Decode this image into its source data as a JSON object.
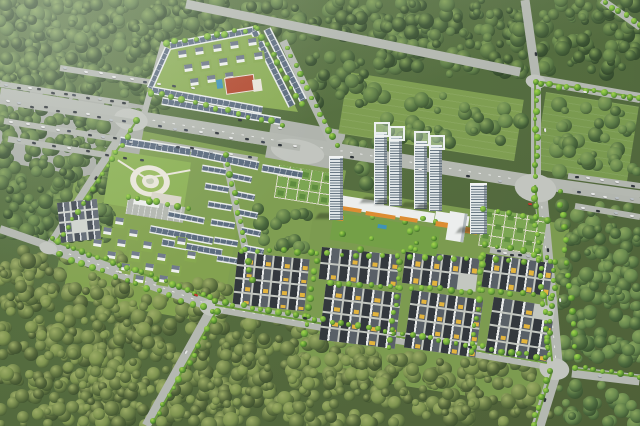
{
  "scene": {
    "description": "Aerial perspective rendering of a master-planned residential development: gated villa compound, high-rise twin towers with retail podium, rows of dark-roofed townhouses with yellow balconies, central amphitheater park, formal parterre gardens and tree-lined boulevards, all surrounded by dense forest",
    "size": {
      "w": 640,
      "h": 426
    },
    "seed": 20240712,
    "palette": {
      "road": "#b4b8b1",
      "road_light": "#c2c5bf",
      "asphalt": "#a9ada6",
      "hedge": "#6f9c3f",
      "forest_dark": [
        "#3d5634",
        "#49653c",
        "#567343",
        "#5f7e49"
      ],
      "forest_dark_hi": "#82a058",
      "forest_mid": [
        "#4c6a3e",
        "#5a7a46",
        "#68894e"
      ],
      "forest_mid_hi": "#8aa65e",
      "forest_olive": [
        "#54663a",
        "#617541",
        "#6f8449",
        "#7d934f"
      ],
      "forest_olive_hi": "#9cac66",
      "street_tree": [
        "#5d9a33",
        "#6fae3b"
      ],
      "street_tree_hi": "#a8d44f",
      "grass": "#7f9e52",
      "lawn": "#8db257",
      "roof_slate": "#5b6b7e",
      "wall_white": "#e9ecec",
      "unit_dark_l": "#33383d",
      "unit_dark_r": "#596067",
      "unit_ridge": "#e9ebea",
      "unit_ground": "#c3c7c0",
      "accent_yellow": "#e3b43d",
      "slate_l": "#454c55",
      "slate_r": "#626a74",
      "slate_ground": "#cfd3cd",
      "tower_face": "#dfe5e7",
      "tower_band": "#6b7a86",
      "tower_cap": "#f2f4f4",
      "podium_white": "#eceeed",
      "podium_orange": "#dd8d33",
      "court_red": "#b2492f",
      "pool_blue": "#3f93b8",
      "park_path": "#e9e6da",
      "plaza": "#d9d5c8",
      "garden_base": "#7ca653",
      "garden_hedge": "#5e8c3f",
      "garden_line": "#dedaca"
    },
    "car_colors": [
      "#2c3237",
      "#e6e7e6",
      "#b9bfc4",
      "#30363c",
      "#3c4450",
      "#e6e7e6"
    ],
    "grass_pads": [
      [
        86,
        120,
        265,
        160,
        11,
        "#7f9e52"
      ],
      [
        80,
        198,
        160,
        100,
        10,
        "#83a250"
      ],
      [
        318,
        185,
        255,
        185,
        9,
        "#7c9b50"
      ],
      [
        0,
        80,
        150,
        80,
        10,
        "#a9ada6"
      ],
      [
        272,
        118,
        75,
        40,
        10,
        "#b0b4ad"
      ]
    ],
    "meadows": [
      [
        348,
        72,
        178,
        62,
        9,
        "#7f9e52"
      ],
      [
        546,
        92,
        94,
        78,
        9,
        "#7a9a50"
      ]
    ],
    "forest_zones": [
      [
        0,
        0,
        200,
        92,
        85,
        "dark"
      ],
      [
        0,
        58,
        110,
        180,
        85,
        "dark"
      ],
      [
        58,
        138,
        52,
        80,
        110,
        "dark"
      ],
      [
        148,
        0,
        235,
        40,
        85,
        "dark"
      ],
      [
        378,
        0,
        150,
        74,
        85,
        "dark"
      ],
      [
        538,
        0,
        102,
        74,
        85,
        "dark"
      ],
      [
        120,
        25,
        48,
        100,
        110,
        "dark"
      ],
      [
        305,
        55,
        80,
        50,
        110,
        "dark"
      ],
      [
        555,
        100,
        85,
        72,
        160,
        "mid"
      ],
      [
        560,
        205,
        80,
        160,
        95,
        "mid"
      ],
      [
        558,
        385,
        82,
        41,
        110,
        "mid"
      ],
      [
        338,
        142,
        46,
        52,
        160,
        "mid"
      ],
      [
        246,
        202,
        66,
        46,
        160,
        "mid"
      ],
      [
        378,
        96,
        150,
        48,
        220,
        "mid"
      ],
      [
        0,
        250,
        125,
        176,
        85,
        "olive"
      ],
      [
        95,
        282,
        135,
        144,
        85,
        "olive"
      ],
      [
        205,
        322,
        175,
        104,
        85,
        "olive"
      ],
      [
        355,
        358,
        195,
        68,
        95,
        "olive"
      ]
    ],
    "roads": [
      [
        0,
        95,
        133,
        117,
        15
      ],
      [
        133,
        117,
        533,
        182,
        14,
        1
      ],
      [
        533,
        182,
        640,
        197,
        13
      ],
      [
        186,
        4,
        520,
        72,
        9
      ],
      [
        537,
        80,
        640,
        98,
        10
      ],
      [
        525,
        0,
        536,
        78,
        9
      ],
      [
        536,
        80,
        536,
        180,
        10
      ],
      [
        540,
        186,
        556,
        362,
        13,
        1
      ],
      [
        556,
        368,
        538,
        426,
        13
      ],
      [
        572,
        372,
        640,
        380,
        11
      ],
      [
        133,
        117,
        50,
        246,
        9
      ],
      [
        0,
        229,
        52,
        247,
        8
      ],
      [
        50,
        247,
        213,
        306,
        12,
        1
      ],
      [
        213,
        306,
        548,
        364,
        12,
        1
      ],
      [
        213,
        306,
        146,
        426,
        9
      ],
      [
        602,
        0,
        640,
        27,
        7
      ],
      [
        283,
        41,
        336,
        151,
        8
      ],
      [
        164,
        42,
        143,
        118,
        6
      ],
      [
        224,
        152,
        253,
        284,
        7
      ]
    ],
    "intersections": [
      [
        133,
        117,
        34,
        22,
        10
      ],
      [
        538,
        185,
        42,
        28,
        9
      ],
      [
        213,
        306,
        24,
        16,
        10
      ],
      [
        556,
        367,
        30,
        22,
        8
      ],
      [
        537,
        80,
        20,
        14,
        10
      ],
      [
        50,
        246,
        18,
        12,
        15
      ],
      [
        300,
        147,
        54,
        24,
        10
      ]
    ],
    "hedges": [
      [
        215,
        305,
        547,
        363
      ],
      [
        535,
        185,
        552,
        361
      ],
      [
        535,
        81,
        535,
        177
      ],
      [
        540,
        82,
        640,
        98
      ],
      [
        53,
        241,
        213,
        300
      ],
      [
        137,
        120,
        55,
        243
      ],
      [
        217,
        310,
        152,
        424
      ],
      [
        574,
        369,
        640,
        377
      ],
      [
        552,
        371,
        535,
        425
      ]
    ],
    "parking_lanes": [
      [
        0,
        84,
        128,
        104,
        11
      ],
      [
        0,
        101,
        133,
        122,
        10
      ],
      [
        4,
        121,
        140,
        143,
        9
      ],
      [
        8,
        139,
        148,
        162,
        8
      ],
      [
        60,
        68,
        200,
        90,
        9
      ],
      [
        150,
        124,
        300,
        148,
        10
      ],
      [
        150,
        142,
        258,
        160,
        6
      ],
      [
        568,
        176,
        640,
        186,
        5
      ],
      [
        572,
        191,
        640,
        201,
        5
      ],
      [
        575,
        206,
        640,
        217,
        4
      ],
      [
        490,
        250,
        536,
        258,
        3
      ]
    ],
    "park": {
      "lawn": [
        112,
        150,
        80,
        54,
        9
      ],
      "fan_center": [
        150,
        181
      ],
      "rings": [
        [
          40,
          "#e9e6da"
        ],
        [
          28,
          "#9abb60"
        ],
        [
          17,
          "#e9e6da"
        ],
        [
          8,
          "#c3cab1"
        ]
      ],
      "plaza": [
        152,
        192,
        30,
        11,
        9
      ],
      "lot": [
        128,
        198,
        58,
        16,
        9
      ],
      "canopy": [
        134,
        199,
        26,
        5
      ],
      "paths": [
        [
          118,
          160,
          146,
          178
        ],
        [
          146,
          178,
          190,
          170
        ]
      ]
    },
    "gardens": [
      [
        484,
        208,
        64,
        38,
        9
      ],
      [
        279,
        165,
        56,
        33,
        9
      ]
    ],
    "compound": {
      "base": [
        145,
        25,
        165,
        125
      ],
      "clip": [
        [
          22,
          20
        ],
        [
          113,
          2
        ],
        [
          153,
          87
        ],
        [
          2,
          67
        ]
      ],
      "rows": [
        [
          170,
          46,
          254,
          30,
          8
        ],
        [
          168,
          48,
          150,
          88,
          7
        ],
        [
          152,
          90,
          262,
          110,
          8
        ],
        [
          162,
          101,
          280,
          121,
          8
        ],
        [
          254,
          31,
          292,
          106,
          8
        ],
        [
          267,
          29,
          303,
          100,
          8
        ]
      ],
      "villas": [
        [
          178,
          52
        ],
        [
          195,
          49
        ],
        [
          213,
          46
        ],
        [
          230,
          43
        ],
        [
          248,
          40
        ],
        [
          184,
          66
        ],
        [
          201,
          63
        ],
        [
          219,
          60
        ],
        [
          236,
          57
        ],
        [
          254,
          54
        ],
        [
          190,
          80
        ],
        [
          207,
          77
        ],
        [
          225,
          74
        ]
      ],
      "court": [
        224,
        78,
        28,
        15,
        -8
      ],
      "deck": [
        252,
        80,
        9,
        12,
        -8
      ],
      "pool": [
        216,
        80,
        6,
        9,
        -8
      ]
    },
    "row_houses": [
      [
        120,
        141,
        190,
        152,
        9
      ],
      [
        191,
        152,
        259,
        166,
        9
      ],
      [
        262,
        168,
        302,
        175,
        8
      ],
      [
        150,
        229,
        213,
        241,
        8
      ],
      [
        162,
        242,
        222,
        253,
        8
      ],
      [
        168,
        214,
        204,
        221,
        7
      ],
      [
        202,
        168,
        226,
        172,
        7
      ],
      [
        205,
        186,
        229,
        190,
        7
      ],
      [
        208,
        204,
        232,
        208,
        7
      ],
      [
        211,
        222,
        235,
        226,
        7
      ],
      [
        214,
        240,
        238,
        244,
        7
      ],
      [
        217,
        258,
        241,
        262,
        7
      ],
      [
        232,
        176,
        252,
        180,
        7
      ],
      [
        235,
        194,
        255,
        198,
        7
      ],
      [
        238,
        212,
        258,
        216,
        7
      ],
      [
        241,
        230,
        261,
        234,
        7
      ],
      [
        244,
        248,
        264,
        252,
        7
      ]
    ],
    "villas": [
      [
        104,
        228
      ],
      [
        118,
        240
      ],
      [
        132,
        252
      ],
      [
        146,
        264
      ],
      [
        160,
        276
      ],
      [
        116,
        218
      ],
      [
        130,
        230
      ],
      [
        144,
        242
      ],
      [
        158,
        254
      ],
      [
        172,
        266
      ],
      [
        94,
        240
      ],
      [
        108,
        252
      ],
      [
        122,
        264
      ],
      [
        136,
        276
      ],
      [
        178,
        238
      ],
      [
        188,
        252
      ]
    ],
    "mini_block": [
      57,
      203,
      40,
      40,
      -6,
      3,
      4
    ],
    "dark_blocks": [
      [
        238,
        252,
        72,
        52,
        6,
        4,
        4
      ],
      [
        322,
        247,
        78,
        32,
        6,
        4,
        2
      ],
      [
        406,
        250,
        74,
        33,
        7,
        4,
        2
      ],
      [
        486,
        254,
        68,
        33,
        8,
        4,
        2
      ],
      [
        326,
        284,
        76,
        56,
        7,
        4,
        4
      ],
      [
        412,
        290,
        72,
        58,
        8,
        4,
        4
      ],
      [
        494,
        297,
        62,
        56,
        9,
        3,
        4
      ]
    ],
    "podium": {
      "strips": [
        [
          333,
          194,
          52,
          11,
          9
        ],
        [
          358,
          201,
          78,
          10,
          9
        ],
        [
          436,
          211,
          34,
          10,
          9
        ]
      ],
      "awnings": [
        [
          336,
          205,
          26,
          4,
          9
        ],
        [
          366,
          211,
          30,
          4,
          9
        ],
        [
          400,
          216,
          18,
          4,
          9
        ],
        [
          436,
          221,
          20,
          5,
          9
        ],
        [
          460,
          226,
          18,
          6,
          9
        ],
        [
          330,
          214,
          14,
          5,
          9
        ]
      ],
      "courtyard": [
        334,
        212,
        108,
        28,
        9
      ],
      "pool": [
        378,
        224,
        9,
        4
      ],
      "low_block": [
        450,
        211,
        18,
        29
      ]
    },
    "towers": [
      [
        329,
        156,
        13,
        62,
        "slab"
      ],
      [
        374,
        132,
        12,
        70,
        "twin"
      ],
      [
        389,
        136,
        12,
        68,
        "twin"
      ],
      [
        414,
        141,
        12,
        66,
        "twin"
      ],
      [
        429,
        145,
        12,
        64,
        "twin"
      ],
      [
        470,
        183,
        16,
        49,
        "slab"
      ]
    ],
    "tree_lines": [
      [
        52,
        240,
        210,
        298,
        8
      ],
      [
        216,
        302,
        546,
        358,
        9
      ],
      [
        60,
        255,
        214,
        312,
        12
      ],
      [
        533,
        190,
        549,
        356,
        9
      ],
      [
        560,
        192,
        576,
        358,
        12
      ],
      [
        536,
        82,
        536,
        176,
        9
      ],
      [
        540,
        83,
        640,
        99,
        9
      ],
      [
        604,
        2,
        640,
        26,
        9
      ],
      [
        550,
        372,
        534,
        424,
        9
      ],
      [
        576,
        368,
        640,
        376,
        9
      ],
      [
        137,
        122,
        58,
        242,
        9
      ],
      [
        218,
        312,
        154,
        422,
        10
      ],
      [
        288,
        48,
        336,
        146,
        9
      ],
      [
        226,
        154,
        252,
        280,
        10
      ],
      [
        166,
        44,
        256,
        28,
        10
      ],
      [
        258,
        28,
        302,
        104,
        10
      ],
      [
        150,
        92,
        282,
        124,
        11
      ],
      [
        318,
        252,
        304,
        344,
        9
      ],
      [
        402,
        252,
        390,
        348,
        9
      ],
      [
        484,
        256,
        472,
        352,
        9
      ],
      [
        556,
        262,
        546,
        358,
        9
      ],
      [
        330,
        283,
        552,
        296,
        10
      ],
      [
        242,
        250,
        552,
        262,
        14
      ],
      [
        128,
        196,
        188,
        208,
        10
      ],
      [
        484,
        208,
        548,
        219,
        12
      ],
      [
        484,
        244,
        548,
        256,
        12
      ]
    ],
    "road_cars": [
      [
        352,
        157,
        9,
        0
      ],
      [
        420,
        169,
        9,
        1
      ],
      [
        468,
        176,
        9,
        3
      ],
      [
        500,
        181,
        9,
        2
      ],
      [
        530,
        204,
        9,
        -1
      ],
      [
        585,
        92,
        10,
        1
      ],
      [
        536,
        54,
        82,
        0
      ],
      [
        545,
        130,
        84,
        1
      ],
      [
        96,
        178,
        122,
        0
      ],
      [
        120,
        272,
        20,
        1
      ],
      [
        196,
        295,
        20,
        -1
      ],
      [
        305,
        318,
        10,
        0
      ],
      [
        390,
        333,
        10,
        1
      ],
      [
        470,
        347,
        10,
        3
      ],
      [
        560,
        300,
        84,
        1
      ],
      [
        548,
        250,
        84,
        0
      ],
      [
        600,
        376,
        6,
        2
      ],
      [
        545,
        400,
        108,
        0
      ],
      [
        186,
        352,
        120,
        1
      ],
      [
        240,
        120,
        9,
        0
      ],
      [
        280,
        128,
        9,
        1
      ],
      [
        505,
        253,
        9,
        1
      ],
      [
        520,
        255,
        9,
        0
      ]
    ],
    "red_car_color": "#c03b2e"
  }
}
